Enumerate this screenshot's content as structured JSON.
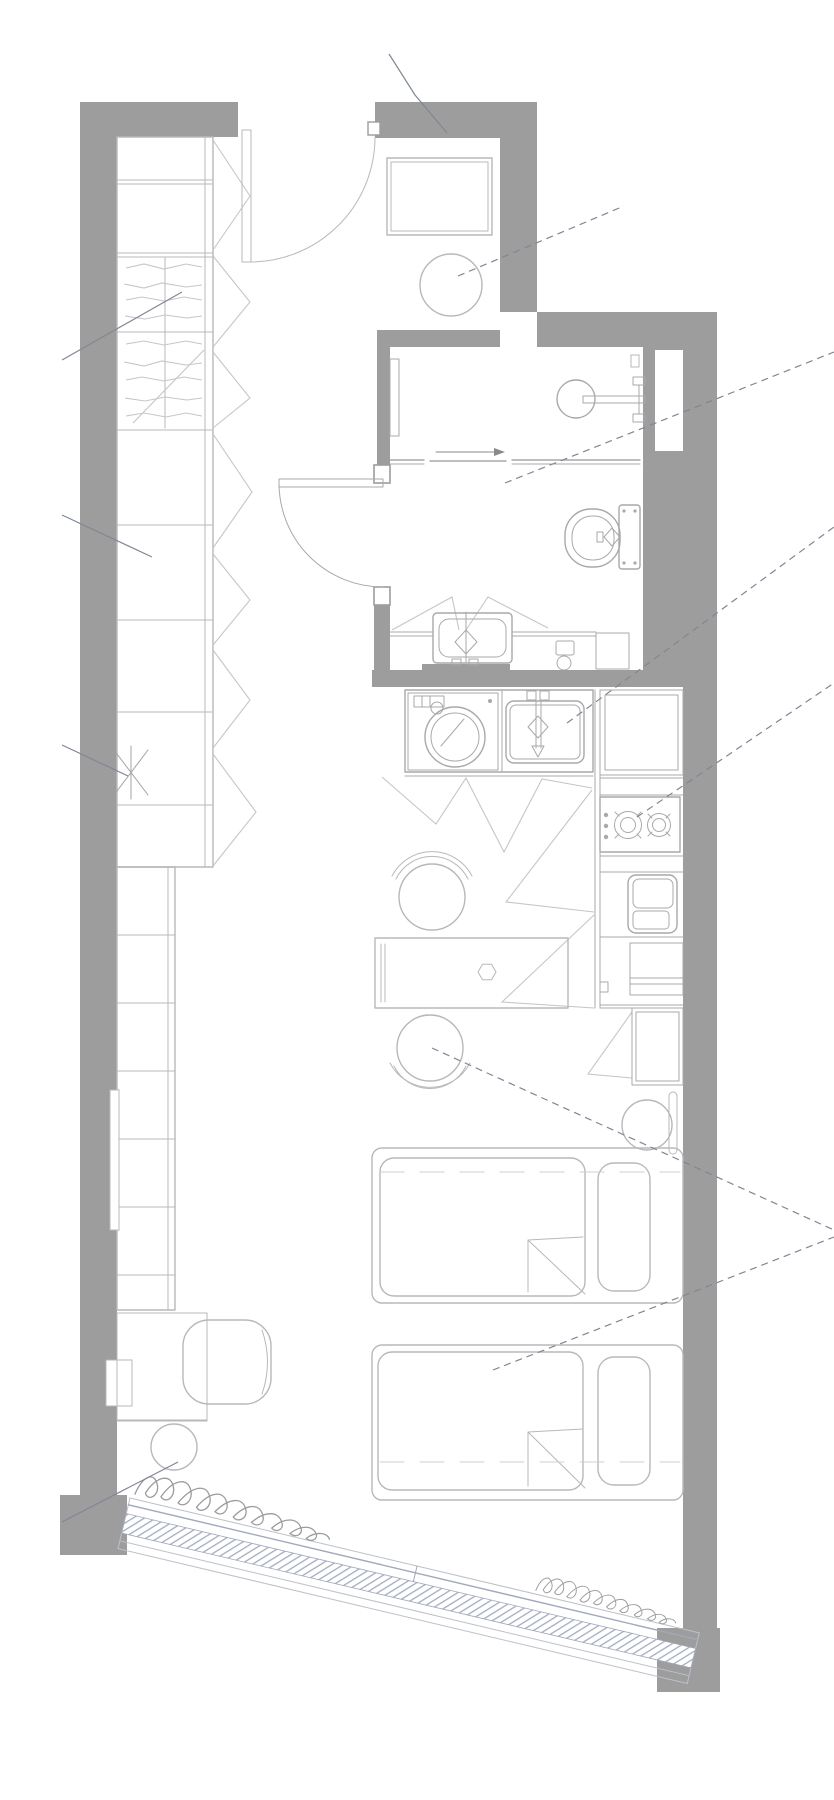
{
  "document": {
    "kind": "architectural floor plan",
    "view": "top-down",
    "units_shown": "none",
    "text_labels": "none (drawing only, leader annotation lines without text)"
  },
  "colors": {
    "background": "#ffffff",
    "wall": "#9d9d9d",
    "furniture_line": "#b8b8b8",
    "fixture_line": "#a9a9a9",
    "door_swing_line": "#c6c6c6",
    "detail_line": "#c6c6c6",
    "leader_line": "#7f8795",
    "window_frame": "#9fa8bc",
    "sill_line": "#bcc0ca",
    "curtain_line": "#9b9b9b",
    "bed_dash": "#cfcfcf"
  },
  "rooms": [
    {
      "id": "entry",
      "name": "entry hall",
      "fixtures": [
        "entry swing door",
        "shoe cabinet",
        "round stool"
      ]
    },
    {
      "id": "bathroom",
      "name": "bathroom",
      "fixtures": [
        "hinged door",
        "wall shower head",
        "sliding shower partition with direction arrow",
        "toilet with cistern",
        "washbasin vanity with cabinet-door swings",
        "small side fixture",
        "service duct shaft in wall"
      ]
    },
    {
      "id": "kitchen",
      "name": "kitchenette",
      "fixtures": [
        "washing machine",
        "kitchen sink with mixer tap",
        "worktop",
        "2-burner cooktop with 3 control dots",
        "built-in oven drawer",
        "tall cabinets with door swings"
      ]
    },
    {
      "id": "living",
      "name": "living / sleeping area",
      "fixtures": [
        "full-height wardrobe run with clothes-hanger scribbles",
        "narrow shelving column",
        "utility asterisk marker",
        "dining table with hexagonal object",
        "two round chairs with backrests",
        "two single beds with duvet folds and pillows",
        "bedside round stool",
        "wall cabinet units",
        "armchair",
        "round side table",
        "wall radiator strips",
        "diagonal glazed window band",
        "two curtain scribbles"
      ]
    }
  ],
  "doors": {
    "entry": "swing-in",
    "bathroom": "swing-out to hall",
    "shower": "sliding, arrow to the right"
  },
  "beds": {
    "count": 2,
    "pillow_side": "right",
    "duvet_fold_corner": "bottom-right",
    "dashed_centerlines": true
  },
  "cooktop": {
    "burners": 2,
    "control_dots": 3
  },
  "window": {
    "position": "bottom edge, diagonal (~13deg)",
    "glazing_hatch": true,
    "corner_column": true
  },
  "leader_lines": {
    "count": 11,
    "style": "thin gray, several dashed, pointing to fixtures and crossing walls"
  }
}
